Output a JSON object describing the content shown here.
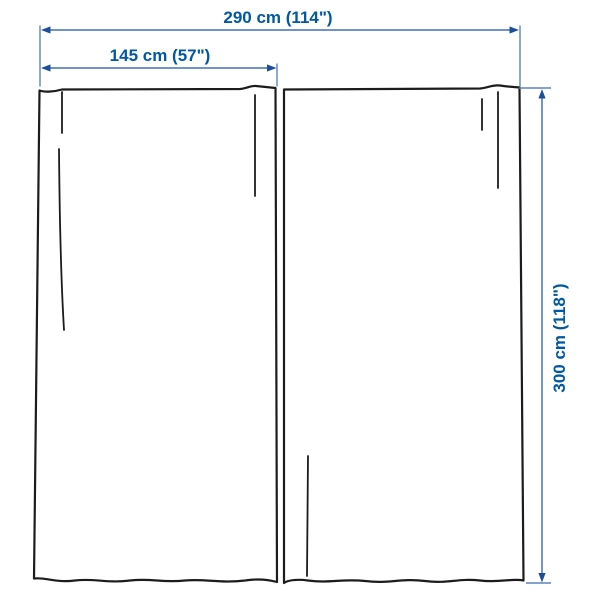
{
  "diagram": {
    "kind": "product-dimension-diagram",
    "subject": "pair of curtain panels with measurement lines",
    "labels": {
      "total_width": "290 cm (114\")",
      "panel_width": "145 cm (57\")",
      "panel_height": "300 cm (118\")"
    },
    "colors": {
      "label_text": "#0058a3",
      "dimension_line": "#5b84bd",
      "dimension_arrow": "#1e4f9c",
      "curtain_outline": "#1c1c1c",
      "background": "#ffffff"
    }
  }
}
